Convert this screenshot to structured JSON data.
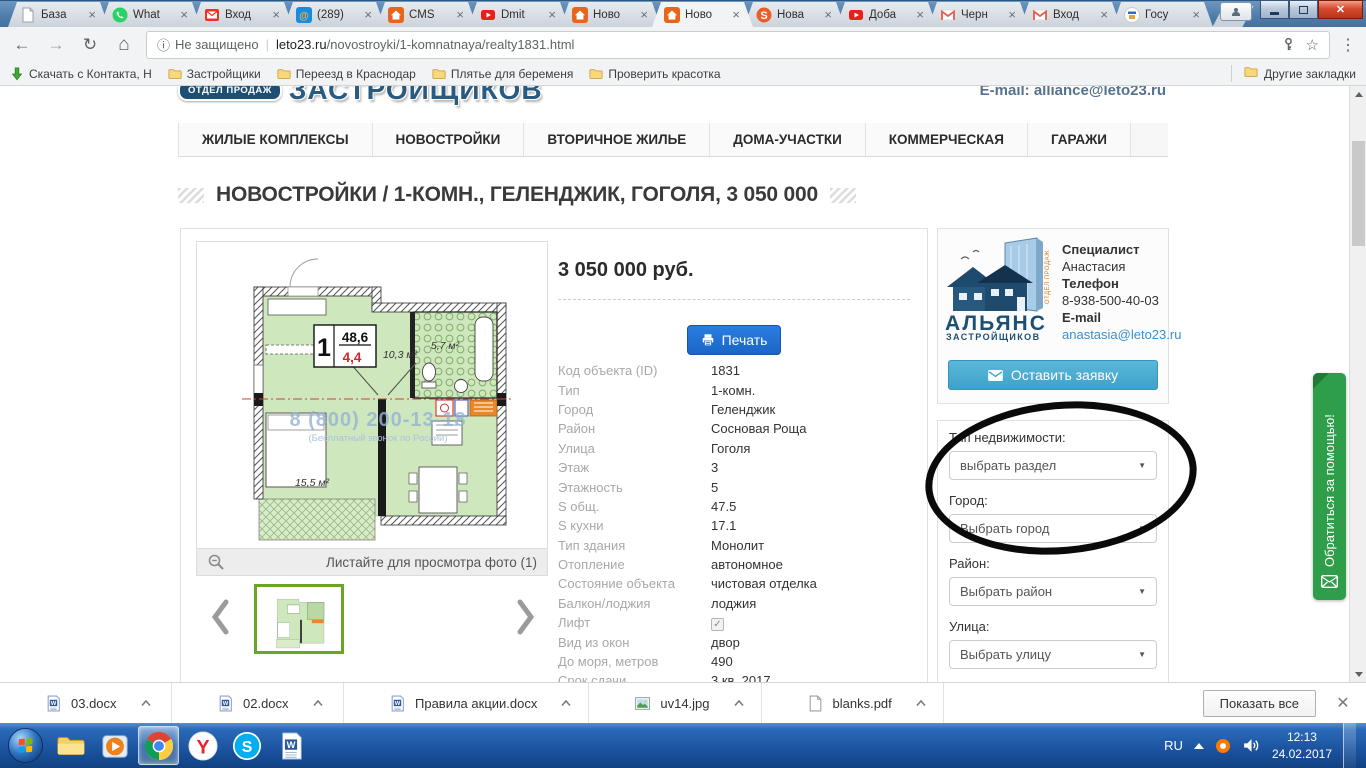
{
  "browser": {
    "tabs": [
      {
        "title": "База",
        "icon": "doc"
      },
      {
        "title": "What",
        "icon": "whatsapp"
      },
      {
        "title": "Вход",
        "icon": "ymail"
      },
      {
        "title": "(289)",
        "icon": "mailru"
      },
      {
        "title": "CMS",
        "icon": "house"
      },
      {
        "title": "Dmit",
        "icon": "youtube"
      },
      {
        "title": "Ново",
        "icon": "house"
      },
      {
        "title": "Ново",
        "icon": "house",
        "active": true
      },
      {
        "title": "Нова",
        "icon": "sbadge"
      },
      {
        "title": "Доба",
        "icon": "youtube"
      },
      {
        "title": "Черн",
        "icon": "gmail"
      },
      {
        "title": "Вход",
        "icon": "gmail"
      },
      {
        "title": "Госу",
        "icon": "gos"
      }
    ],
    "address": {
      "security": "Не защищено",
      "domain": "leto23.ru",
      "path": "/novostroyki/1-komnatnaya/realty1831.html"
    },
    "bookmarks_bar": {
      "items": [
        {
          "label": "Скачать с Контакта, Н",
          "icon": "downarrow"
        },
        {
          "label": "Застройщики",
          "icon": "folder"
        },
        {
          "label": "Переезд в Краснодар",
          "icon": "folder"
        },
        {
          "label": "Плятье для беременя",
          "icon": "folder"
        },
        {
          "label": "Проверить красотка",
          "icon": "folder"
        }
      ],
      "other": "Другие закладки"
    }
  },
  "page": {
    "header": {
      "badge": "ОТДЕЛ ПРОДАЖ",
      "brand": "ЗАСТРОЙЩИКОВ",
      "email": "E-mail: alliance@leto23.ru"
    },
    "nav": [
      "ЖИЛЫЕ КОМПЛЕКСЫ",
      "НОВОСТРОЙКИ",
      "ВТОРИЧНОЕ ЖИЛЬЕ",
      "ДОМА-УЧАСТКИ",
      "КОММЕРЧЕСКАЯ",
      "ГАРАЖИ"
    ],
    "title": "НОВОСТРОЙКИ / 1-КОМН., ГЕЛЕНДЖИК, ГОГОЛЯ, 3 050 000",
    "gallery": {
      "caption": "Листайте для просмотра фото (1)",
      "plan": {
        "room_number": "1",
        "area_total": "48,6",
        "area_extra": "4,4",
        "hall": "10,3 м²",
        "bath": "5,7 м²",
        "bedroom": "15,5 м²",
        "watermark_phone": "8 (800) 200-13-18",
        "watermark_sub": "(Бесплатный звонок по России)"
      }
    },
    "offer": {
      "price": "3 050 000 руб.",
      "print_label": "Печать",
      "details": [
        {
          "label": "Код объекта (ID)",
          "value": "1831"
        },
        {
          "label": "Тип",
          "value": "1-комн."
        },
        {
          "label": "Город",
          "value": "Геленджик"
        },
        {
          "label": "Район",
          "value": "Сосновая Роща"
        },
        {
          "label": "Улица",
          "value": "Гоголя"
        },
        {
          "label": "Этаж",
          "value": "3"
        },
        {
          "label": "Этажность",
          "value": "5"
        },
        {
          "label": "S общ.",
          "value": "47.5"
        },
        {
          "label": "S кухни",
          "value": "17.1"
        },
        {
          "label": "Тип здания",
          "value": "Монолит"
        },
        {
          "label": "Отопление",
          "value": "автономное"
        },
        {
          "label": "Состояние объекта",
          "value": "чистовая отделка"
        },
        {
          "label": "Балкон/лоджия",
          "value": "лоджия"
        },
        {
          "label": "Лифт",
          "value": "",
          "checkbox": true
        },
        {
          "label": "Вид из окон",
          "value": "двор"
        },
        {
          "label": "До моря, метров",
          "value": "490"
        },
        {
          "label": "Срок сдачи",
          "value": "3 кв. 2017"
        }
      ]
    },
    "sidebar": {
      "specialist": {
        "role_label": "Специалист",
        "name": "Анастасия",
        "phone_label": "Телефон",
        "phone": "8-938-500-40-03",
        "email_label": "E-mail",
        "email": "anastasia@leto23.ru",
        "logo_line1": "АЛЬЯНС",
        "logo_line2": "ЗАСТРОЙЩИКОВ",
        "logo_side": "ОТДЕЛ ПРОДАЖ"
      },
      "request_button": "Оставить заявку",
      "filters": [
        {
          "label": "Тип недвижимости:",
          "value": "выбрать раздел"
        },
        {
          "label": "Город:",
          "value": "Выбрать город"
        },
        {
          "label": "Район:",
          "value": "Выбрать район"
        },
        {
          "label": "Улица:",
          "value": "Выбрать улицу"
        }
      ]
    },
    "help_tab": "Обратиться за помощью!"
  },
  "downloads": {
    "items": [
      {
        "name": "03.docx",
        "icon": "word"
      },
      {
        "name": "02.docx",
        "icon": "word"
      },
      {
        "name": "Правила акции.docx",
        "icon": "word"
      },
      {
        "name": "uv14.jpg",
        "icon": "image"
      },
      {
        "name": "blanks.pdf",
        "icon": "pdf"
      }
    ],
    "show_all": "Показать все"
  },
  "taskbar": {
    "apps": [
      "explorer",
      "wmp",
      "chrome",
      "yandex",
      "skype",
      "word"
    ],
    "active_app": "chrome",
    "tray": {
      "lang": "RU",
      "time": "12:13",
      "date": "24.02.2017"
    }
  }
}
